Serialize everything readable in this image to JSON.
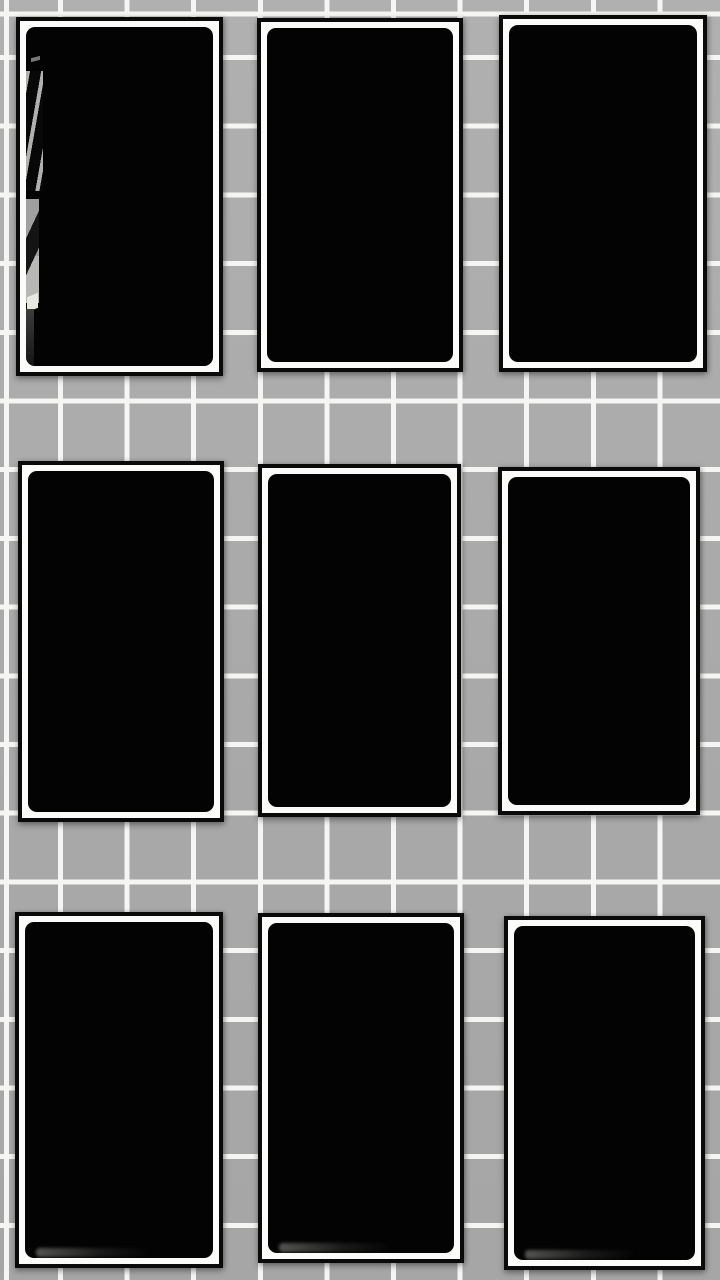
{
  "scene": {
    "type": "photograph",
    "description": "Nine black-framed dark prints hung in a 3x3 grid on a gray square-tiled wall with white grout lines",
    "wall": {
      "tile_color": "#acacac",
      "grout_color": "#f5f5f3",
      "grout_thickness_px": 5,
      "tile_pitch_x_px": 66.6,
      "tile_pitch_y_px": 68.7,
      "first_vertical_grout_x": 58,
      "first_horizontal_grout_y": 55
    },
    "frame_style": {
      "border_color": "#0a0a0a",
      "mat_color": "#fbfbf9",
      "art_color": "#030303",
      "border_px": 4,
      "mat_px": 6,
      "art_corner_radius_px": 9
    },
    "frames": [
      {
        "id": "frame-1",
        "row": 1,
        "col": 1,
        "x": 16,
        "y": 17,
        "w": 207,
        "h": 359,
        "texture": "key-sliver"
      },
      {
        "id": "frame-2",
        "row": 1,
        "col": 2,
        "x": 257,
        "y": 18,
        "w": 206,
        "h": 354,
        "texture": "none"
      },
      {
        "id": "frame-3",
        "row": 1,
        "col": 3,
        "x": 499,
        "y": 15,
        "w": 208,
        "h": 357,
        "texture": "none"
      },
      {
        "id": "frame-4",
        "row": 2,
        "col": 1,
        "x": 18,
        "y": 461,
        "w": 206,
        "h": 361,
        "texture": "none"
      },
      {
        "id": "frame-5",
        "row": 2,
        "col": 2,
        "x": 258,
        "y": 464,
        "w": 203,
        "h": 353,
        "texture": "none"
      },
      {
        "id": "frame-6",
        "row": 2,
        "col": 3,
        "x": 498,
        "y": 467,
        "w": 202,
        "h": 348,
        "texture": "mat-smudge"
      },
      {
        "id": "frame-7",
        "row": 3,
        "col": 1,
        "x": 15,
        "y": 912,
        "w": 208,
        "h": 356,
        "texture": "bottom-smear"
      },
      {
        "id": "frame-8",
        "row": 3,
        "col": 2,
        "x": 258,
        "y": 913,
        "w": 206,
        "h": 350,
        "texture": "bottom-smear"
      },
      {
        "id": "frame-9",
        "row": 3,
        "col": 3,
        "x": 504,
        "y": 916,
        "w": 201,
        "h": 354,
        "texture": "bottom-smear"
      }
    ]
  }
}
